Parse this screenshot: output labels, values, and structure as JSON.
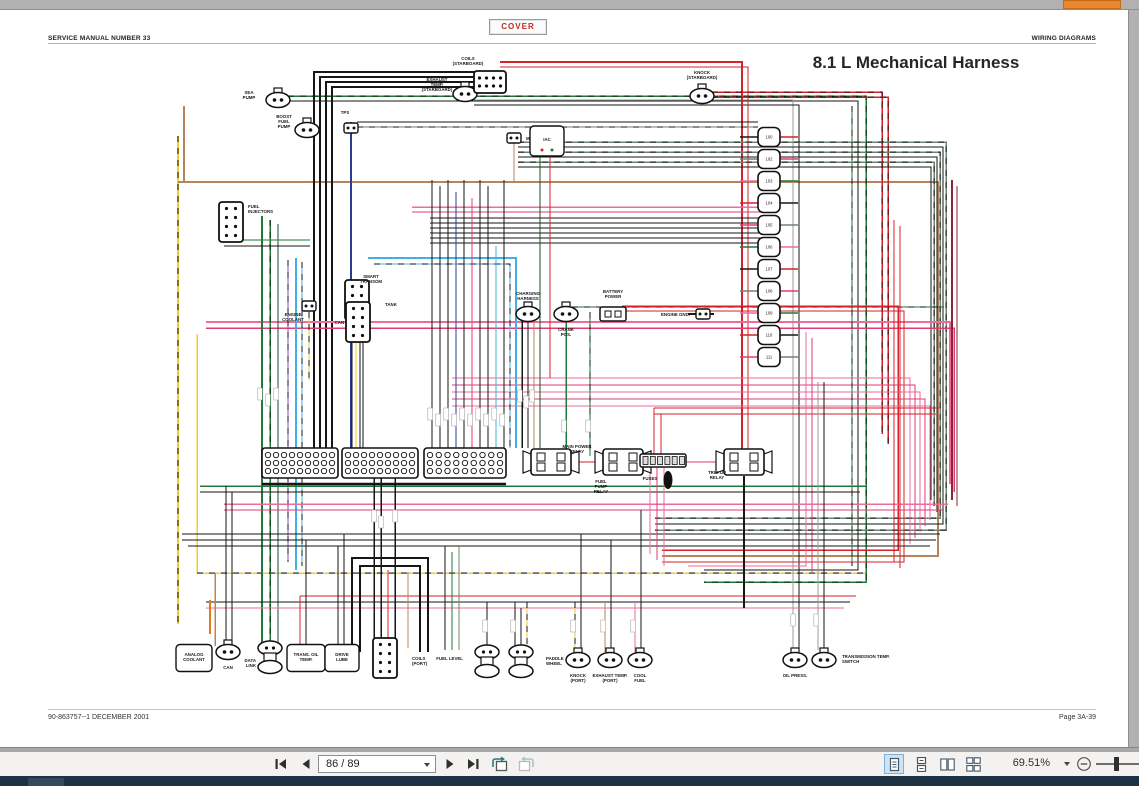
{
  "header": {
    "left": "SERVICE MANUAL NUMBER 33",
    "cover_label": "COVER",
    "right": "WIRING DIAGRAMS"
  },
  "page": {
    "title": "8.1 L Mechanical Harness",
    "footer_left": "90-863757--1   DECEMBER 2001",
    "footer_right": "Page 3A-39"
  },
  "toolbar": {
    "page_display": "86 / 89",
    "zoom_display": "69.51%"
  },
  "colors": {
    "cover_red": "#c3291c",
    "header_rule": "#e89a96",
    "statusbar_navy": "#1e3245",
    "scroll_thumb_orange": "#e8872e",
    "selected_view_bg": "#cfe3f6"
  },
  "diagram": {
    "modules": [
      "100",
      "102",
      "103",
      "104",
      "105",
      "106",
      "107",
      "108",
      "109",
      "110",
      "111"
    ],
    "ecm": {
      "x": 262,
      "y": 438,
      "w": 246,
      "h": 30
    },
    "components": [
      {
        "name": "sea-pump",
        "glyph": "oval",
        "x": 278,
        "y": 90,
        "label": {
          "x": 249,
          "y": 84,
          "anchor": "middle",
          "lines": [
            "SEA",
            "PUMP"
          ]
        }
      },
      {
        "name": "boost-fuel-pump",
        "glyph": "oval",
        "x": 307,
        "y": 120,
        "label": {
          "x": 284,
          "y": 108,
          "anchor": "middle",
          "lines": [
            "BOOST",
            "FUEL",
            "PUMP"
          ]
        }
      },
      {
        "name": "tps",
        "glyph": "plug",
        "x": 351,
        "y": 118,
        "label": {
          "x": 345,
          "y": 104,
          "anchor": "middle",
          "lines": [
            "TPS"
          ]
        }
      },
      {
        "name": "exhaust-temp-starboard",
        "glyph": "oval",
        "x": 465,
        "y": 84,
        "label": {
          "x": 437,
          "y": 71,
          "anchor": "middle",
          "lines": [
            "EXHAUST",
            "TEMP.",
            "(STARBOARD)"
          ]
        }
      },
      {
        "name": "coils-starboard",
        "glyph": "bigH",
        "x": 490,
        "y": 72,
        "label": {
          "x": 468,
          "y": 50,
          "anchor": "middle",
          "lines": [
            "COILS",
            "(STARBOARD)"
          ]
        }
      },
      {
        "name": "mat",
        "glyph": "plug",
        "x": 514,
        "y": 128,
        "label": {
          "x": 526,
          "y": 130,
          "anchor": "start",
          "lines": [
            "MAT"
          ]
        }
      },
      {
        "name": "iac",
        "glyph": "boxlabel",
        "x": 547,
        "y": 131,
        "bw": 34,
        "bh": 30,
        "label": {
          "x": 547,
          "y": 131,
          "anchor": "middle",
          "lines": [
            "IAC"
          ]
        }
      },
      {
        "name": "knock-starboard",
        "glyph": "oval",
        "x": 702,
        "y": 86,
        "label": {
          "x": 702,
          "y": 64,
          "anchor": "middle",
          "lines": [
            "KNOCK",
            "(STARBOARD)"
          ]
        }
      },
      {
        "name": "fuel-injectors",
        "glyph": "bigV",
        "x": 231,
        "y": 212,
        "label": {
          "x": 248,
          "y": 198,
          "anchor": "start",
          "lines": [
            "FUEL",
            "INJECTORS"
          ]
        }
      },
      {
        "name": "engine-coolant",
        "glyph": "plug",
        "x": 309,
        "y": 296,
        "label": {
          "x": 293,
          "y": 306,
          "anchor": "middle",
          "lines": [
            "ENGINE",
            "COOLANT"
          ]
        }
      },
      {
        "name": "smart-transom",
        "glyph": "bigV",
        "x": 357,
        "y": 290,
        "label": {
          "x": 371,
          "y": 268,
          "anchor": "middle",
          "lines": [
            "SMART",
            "TRANSOM"
          ]
        }
      },
      {
        "name": "tank",
        "glyph": "none",
        "x": 385,
        "y": 295,
        "label": {
          "x": 385,
          "y": 296,
          "anchor": "start",
          "lines": [
            "TANK"
          ]
        }
      },
      {
        "name": "can-mid",
        "glyph": "bigV",
        "x": 358,
        "y": 312,
        "label": {
          "x": 344,
          "y": 314,
          "anchor": "end",
          "lines": [
            "CAN"
          ]
        }
      },
      {
        "name": "charging-harness",
        "glyph": "oval",
        "x": 528,
        "y": 304,
        "label": {
          "x": 528,
          "y": 285,
          "anchor": "middle",
          "lines": [
            "CHARGING",
            "HARNESS"
          ]
        }
      },
      {
        "name": "crank-pos",
        "glyph": "oval",
        "x": 566,
        "y": 304,
        "label": {
          "x": 566,
          "y": 321,
          "anchor": "middle",
          "lines": [
            "CRANK",
            "POS."
          ]
        }
      },
      {
        "name": "battery-power",
        "glyph": "plug2",
        "x": 613,
        "y": 304,
        "label": {
          "x": 613,
          "y": 283,
          "anchor": "middle",
          "lines": [
            "BATTERY",
            "POWER"
          ]
        }
      },
      {
        "name": "engine-gnd",
        "glyph": "plug",
        "x": 703,
        "y": 304,
        "label": {
          "x": 690,
          "y": 306,
          "anchor": "end",
          "lines": [
            "ENGINE GND."
          ]
        }
      },
      {
        "name": "main-power-relay",
        "glyph": "relay",
        "x": 551,
        "y": 452,
        "label": {
          "x": 577,
          "y": 438,
          "anchor": "middle",
          "lines": [
            "MAIN POWER",
            "RELAY"
          ]
        }
      },
      {
        "name": "fuel-pump-relay",
        "glyph": "relay",
        "x": 623,
        "y": 452,
        "label": {
          "x": 601,
          "y": 473,
          "anchor": "middle",
          "lines": [
            "FUEL",
            "PUMP",
            "RELAY"
          ]
        }
      },
      {
        "name": "fuses",
        "glyph": "fuse",
        "x": 663,
        "y": 450,
        "label": {
          "x": 650,
          "y": 470,
          "anchor": "middle",
          "lines": [
            "FUSES"
          ]
        }
      },
      {
        "name": "trim-up-relay",
        "glyph": "relay",
        "x": 744,
        "y": 452,
        "label": {
          "x": 717,
          "y": 464,
          "anchor": "middle",
          "lines": [
            "TRIM UP",
            "RELAY"
          ]
        }
      },
      {
        "name": "analog-coolant",
        "glyph": "boxlabel",
        "x": 194,
        "y": 648,
        "bw": 36,
        "bh": 27,
        "label": {
          "x": 194,
          "y": 646,
          "anchor": "middle",
          "lines": [
            "ANALOG",
            "COOLANT"
          ]
        }
      },
      {
        "name": "can-bottom",
        "glyph": "oval",
        "x": 228,
        "y": 642,
        "label": {
          "x": 228,
          "y": 659,
          "anchor": "middle",
          "lines": [
            "CAN"
          ]
        }
      },
      {
        "name": "data-link",
        "glyph": "oval2",
        "x": 270,
        "y": 646,
        "label": {
          "x": 256,
          "y": 652,
          "anchor": "end",
          "lines": [
            "DATA",
            "LINK"
          ]
        }
      },
      {
        "name": "trans-oil-temp",
        "glyph": "boxlabel",
        "x": 306,
        "y": 648,
        "bw": 38,
        "bh": 27,
        "label": {
          "x": 306,
          "y": 646,
          "anchor": "middle",
          "lines": [
            "TRANS. OIL",
            "TEMP."
          ]
        }
      },
      {
        "name": "drive-lube",
        "glyph": "boxlabel",
        "x": 342,
        "y": 648,
        "bw": 34,
        "bh": 27,
        "label": {
          "x": 342,
          "y": 646,
          "anchor": "middle",
          "lines": [
            "DRIVE",
            "LUBE"
          ]
        }
      },
      {
        "name": "coils-port",
        "glyph": "bigV",
        "x": 385,
        "y": 648,
        "label": {
          "x": 412,
          "y": 650,
          "anchor": "start",
          "lines": [
            "COILS",
            "(PORT)"
          ]
        }
      },
      {
        "name": "fuel-level",
        "glyph": "oval2",
        "x": 487,
        "y": 650,
        "label": {
          "x": 463,
          "y": 650,
          "anchor": "end",
          "lines": [
            "FUEL LEVEL"
          ]
        }
      },
      {
        "name": "paddle-wheel",
        "glyph": "oval2",
        "x": 521,
        "y": 650,
        "label": {
          "x": 546,
          "y": 650,
          "anchor": "start",
          "lines": [
            "PADDLE",
            "WHEEL"
          ]
        }
      },
      {
        "name": "knock-port",
        "glyph": "oval",
        "x": 578,
        "y": 650,
        "label": {
          "x": 578,
          "y": 667,
          "anchor": "middle",
          "lines": [
            "KNOCK",
            "(PORT)"
          ]
        }
      },
      {
        "name": "exhaust-temp-port",
        "glyph": "oval",
        "x": 610,
        "y": 650,
        "label": {
          "x": 610,
          "y": 667,
          "anchor": "middle",
          "lines": [
            "EXHAUST TEMP.",
            "(PORT)"
          ]
        }
      },
      {
        "name": "cool-fuel",
        "glyph": "oval",
        "x": 640,
        "y": 650,
        "label": {
          "x": 640,
          "y": 667,
          "anchor": "middle",
          "lines": [
            "COOL",
            "FUEL"
          ]
        }
      },
      {
        "name": "oil-press",
        "glyph": "oval",
        "x": 795,
        "y": 650,
        "label": {
          "x": 795,
          "y": 667,
          "anchor": "middle",
          "lines": [
            "OIL PRESS."
          ]
        }
      },
      {
        "name": "transmission-temp-switch",
        "glyph": "oval",
        "x": 824,
        "y": 650,
        "label": {
          "x": 842,
          "y": 648,
          "anchor": "start",
          "lines": [
            "TRANSMISSION TEMP.",
            "SWITCH"
          ]
        }
      }
    ]
  }
}
